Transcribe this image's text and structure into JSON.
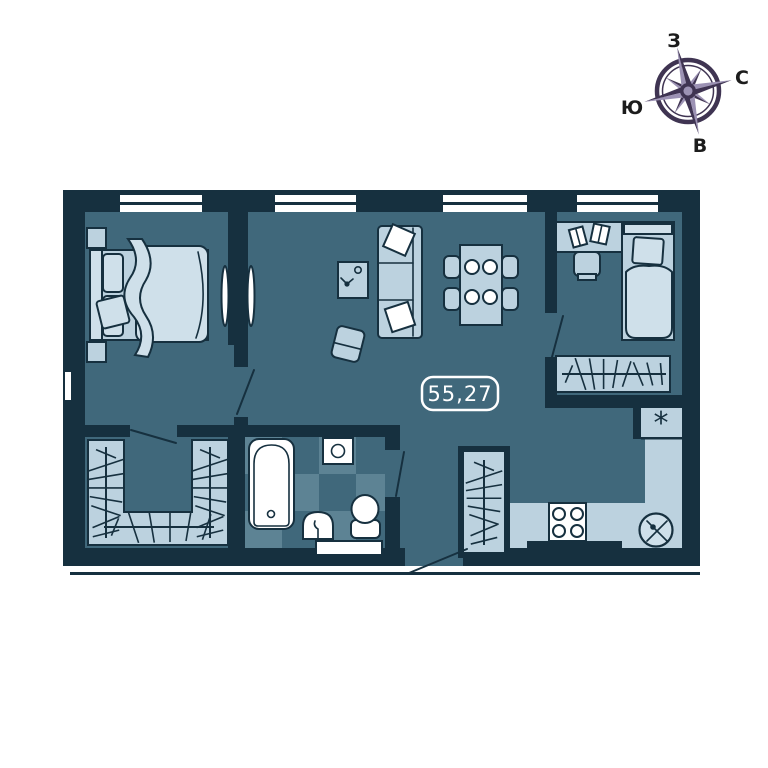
{
  "plan": {
    "area_label": "55,27"
  },
  "compass": {
    "labels": {
      "top": "З",
      "right": "С",
      "left": "Ю",
      "bottom": "В"
    }
  },
  "kitchen": {
    "fridge_symbol": "*"
  },
  "colors": {
    "wall": "#16303f",
    "floor": "#40687b",
    "floor_light": "#5d8394",
    "furniture": "#bcd2df",
    "furniture_light": "#cfe0ea",
    "white": "#ffffff",
    "compass_dark": "#3f3452",
    "compass_light": "#9c92b4",
    "text_dark": "#1c1c1c"
  }
}
